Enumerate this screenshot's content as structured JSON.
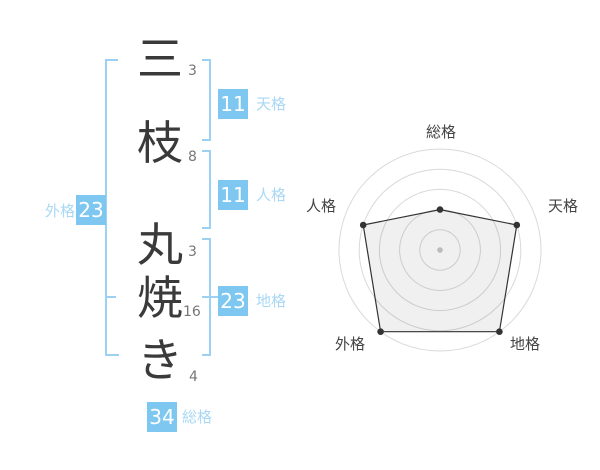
{
  "page": {
    "background": "#FFFFFF"
  },
  "name_analysis": {
    "full_name": "三枝丸焼き",
    "chars": [
      {
        "char": "三",
        "strokes": "3"
      },
      {
        "char": "枝",
        "strokes": "8"
      },
      {
        "char": "丸",
        "strokes": "3"
      },
      {
        "char": "焼",
        "strokes": "16"
      },
      {
        "char": "き",
        "strokes": "4"
      }
    ],
    "kaku": {
      "tenkaku": {
        "label": "天格",
        "value": "11"
      },
      "jinkaku": {
        "label": "人格",
        "value": "11"
      },
      "chikaku": {
        "label": "地格",
        "value": "23"
      },
      "gaikaku": {
        "label": "外格",
        "value": "23"
      },
      "soukaku": {
        "label": "総格",
        "value": "34"
      }
    }
  },
  "chart_data": {
    "type": "radar",
    "title": "",
    "axes": [
      "総格",
      "天格",
      "地格",
      "外格",
      "人格"
    ],
    "values": [
      2,
      4,
      5,
      5,
      4
    ],
    "max": 5,
    "rings": 5,
    "axis_stroke_totals": {
      "総格": 34,
      "天格": 11,
      "地格": 23,
      "外格": 23,
      "人格": 11
    },
    "legend": "none",
    "grid": "concentric-circles",
    "grid_color": "#D9D9D9",
    "line_color": "#333333",
    "fill_color": "rgba(0,0,0,0.06)",
    "point_color": "#333333",
    "center_dot_color": "#BBBBBB"
  },
  "colors": {
    "badge_bg": "#7EC7F0",
    "badge_text": "#FFFFFF",
    "kaku_label": "#A9D8F5",
    "bracket": "#9CD1F3",
    "char_text": "#3A3A3A",
    "stroke_num": "#777777",
    "radar_label": "#444444"
  }
}
